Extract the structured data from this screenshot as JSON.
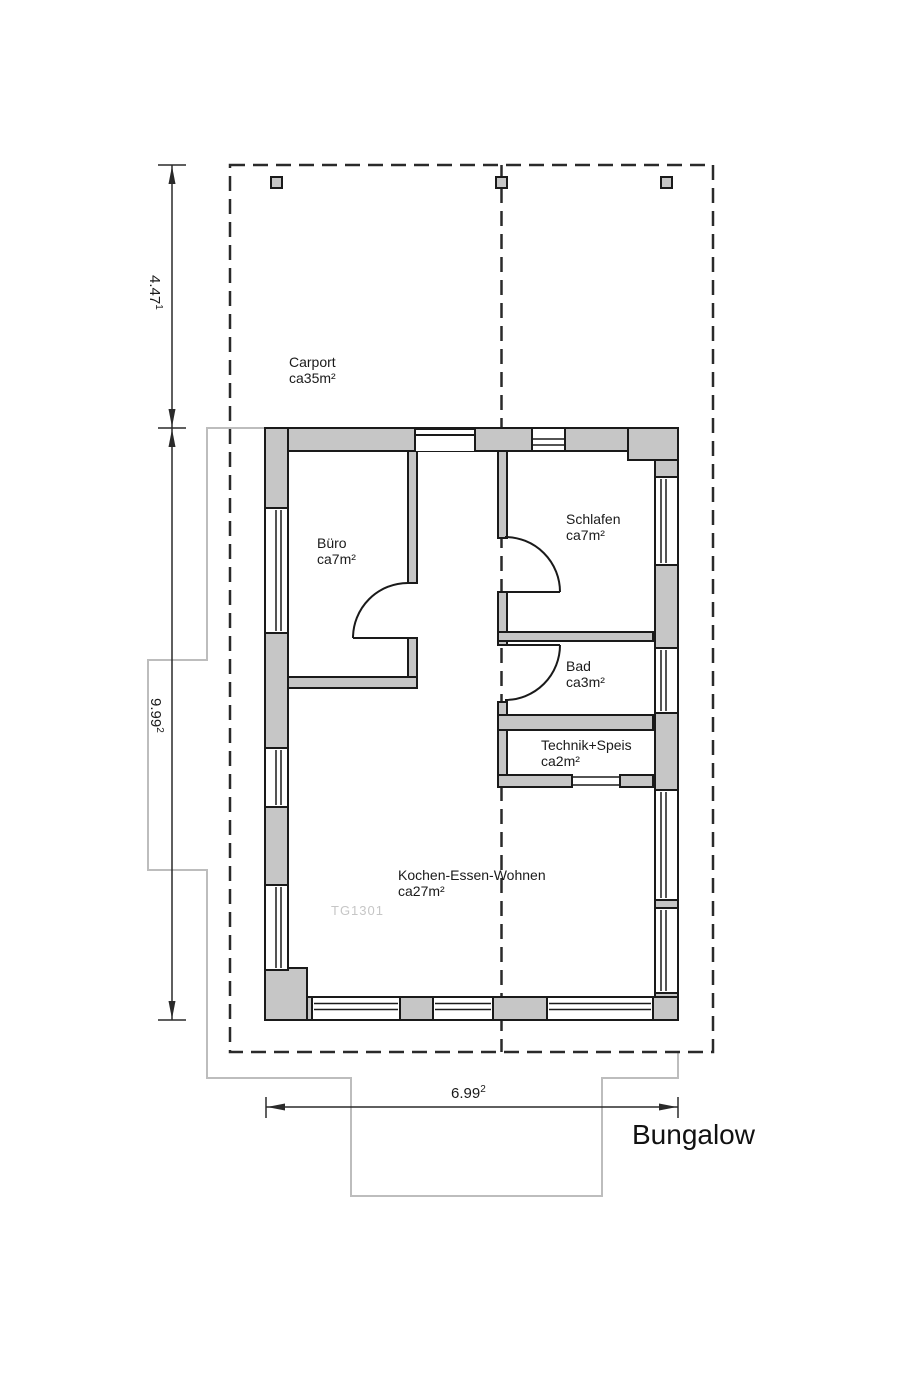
{
  "title": "Bungalow",
  "watermark": "TG1301",
  "rooms": [
    {
      "name": "Carport",
      "area": "ca35m²"
    },
    {
      "name": "Büro",
      "area": "ca7m²"
    },
    {
      "name": "Schlafen",
      "area": "ca7m²"
    },
    {
      "name": "Bad",
      "area": "ca3m²"
    },
    {
      "name": "Technik+Speis",
      "area": "ca2m²"
    },
    {
      "name": "Kochen-Essen-Wohnen",
      "area": "ca27m²"
    }
  ],
  "dimensions": {
    "carport_depth": {
      "value": "4.47",
      "sup": "1"
    },
    "house_depth": {
      "value": "9.99",
      "sup": "2"
    },
    "house_width": {
      "value": "6.99",
      "sup": "2"
    }
  },
  "colors": {
    "wall_fill": "#c6c6c6",
    "line": "#1a1a1a",
    "dashed_line": "#2a2a2a",
    "terrace_outline": "#bdbdbd",
    "watermark": "#c6c6c6"
  }
}
